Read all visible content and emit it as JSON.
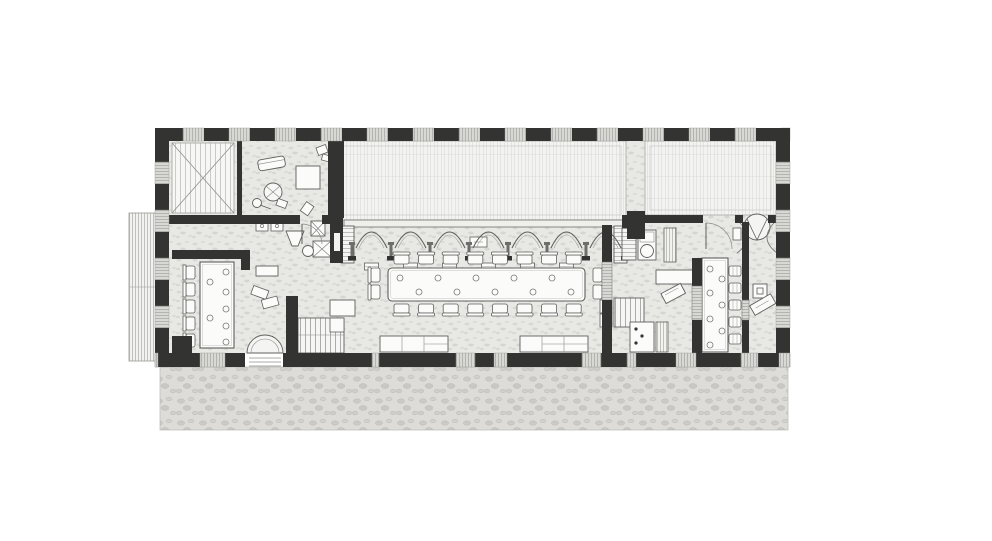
{
  "palette": {
    "wall": "#333331",
    "wall_light": "#4a4a48",
    "line": "#5f5f5d",
    "soft_line": "#9a9a97",
    "window_fill": "#d8d8d5",
    "floor": "#e8e8e5",
    "roof_bg": "#f3f3f1",
    "furniture_fill": "#fbfbfa",
    "terrace_edge": "#b9b8b5"
  },
  "plan": {
    "walls": {
      "top": {
        "x0": 155,
        "x1": 790,
        "y": 128,
        "h": 13,
        "start_pier_w": 28,
        "pier_w": 25,
        "win_w": 21
      },
      "left": {
        "y0": 128,
        "y1": 367,
        "x": 155,
        "w": 14,
        "start_pier_w": 34,
        "pier_w": 26,
        "win_w": 22
      },
      "right": {
        "y0": 128,
        "y1": 367,
        "x": 776,
        "w": 14,
        "start_pier_w": 34,
        "pier_w": 26,
        "win_w": 22
      },
      "bottom": {
        "y": 353,
        "h": 14,
        "x0": 155,
        "x1": 790,
        "segments": [
          [
            158,
            200
          ],
          [
            225,
            245
          ],
          [
            283,
            372
          ],
          [
            379,
            456
          ],
          [
            475,
            494
          ],
          [
            507,
            582
          ],
          [
            601,
            627
          ],
          [
            636,
            676
          ],
          [
            696,
            741
          ],
          [
            758,
            779
          ]
        ],
        "door_gap": [
          245,
          283
        ]
      }
    },
    "arcade": {
      "arch_count": 7,
      "x_start": 352,
      "arch_span": 39,
      "spring_y": 248,
      "apex_y": 220,
      "shaft_top": 230,
      "base_y": 256,
      "stool_count": 6,
      "stool_y": 263
    },
    "dining": {
      "table": {
        "x": 388,
        "y": 268,
        "w": 197,
        "h": 33
      },
      "chairs_top": {
        "count": 8,
        "x0": 394,
        "step": 24.6,
        "y": 252
      },
      "chairs_bottom": {
        "count": 8,
        "x0": 394,
        "step": 24.6,
        "y": 304
      },
      "end_chairs_left_y": [
        268,
        285
      ],
      "end_chairs_right_y": [
        268,
        285
      ],
      "dots": [
        [
          400,
          278
        ],
        [
          419,
          292
        ],
        [
          438,
          278
        ],
        [
          457,
          292
        ],
        [
          476,
          278
        ],
        [
          495,
          292
        ],
        [
          514,
          278
        ],
        [
          533,
          292
        ],
        [
          552,
          278
        ],
        [
          571,
          292
        ]
      ]
    },
    "left_room": {
      "table": {
        "x": 200,
        "y": 262,
        "w": 34,
        "h": 86
      },
      "wall_chairs": {
        "count": 5,
        "x": 186,
        "y0": 266,
        "step": 17
      },
      "dots": [
        [
          226,
          272
        ],
        [
          210,
          282
        ],
        [
          226,
          292
        ],
        [
          226,
          309
        ],
        [
          210,
          318
        ],
        [
          226,
          326
        ],
        [
          226,
          342
        ]
      ]
    },
    "bar": {
      "counter": {
        "x": 702,
        "y": 258,
        "w": 26,
        "h": 94
      },
      "stools": {
        "count": 5,
        "x": 729,
        "y0": 266,
        "step": 17
      },
      "dots": [
        [
          710,
          269
        ],
        [
          722,
          279
        ],
        [
          710,
          293
        ],
        [
          722,
          305
        ],
        [
          710,
          319
        ],
        [
          722,
          331
        ],
        [
          710,
          345
        ]
      ]
    }
  }
}
